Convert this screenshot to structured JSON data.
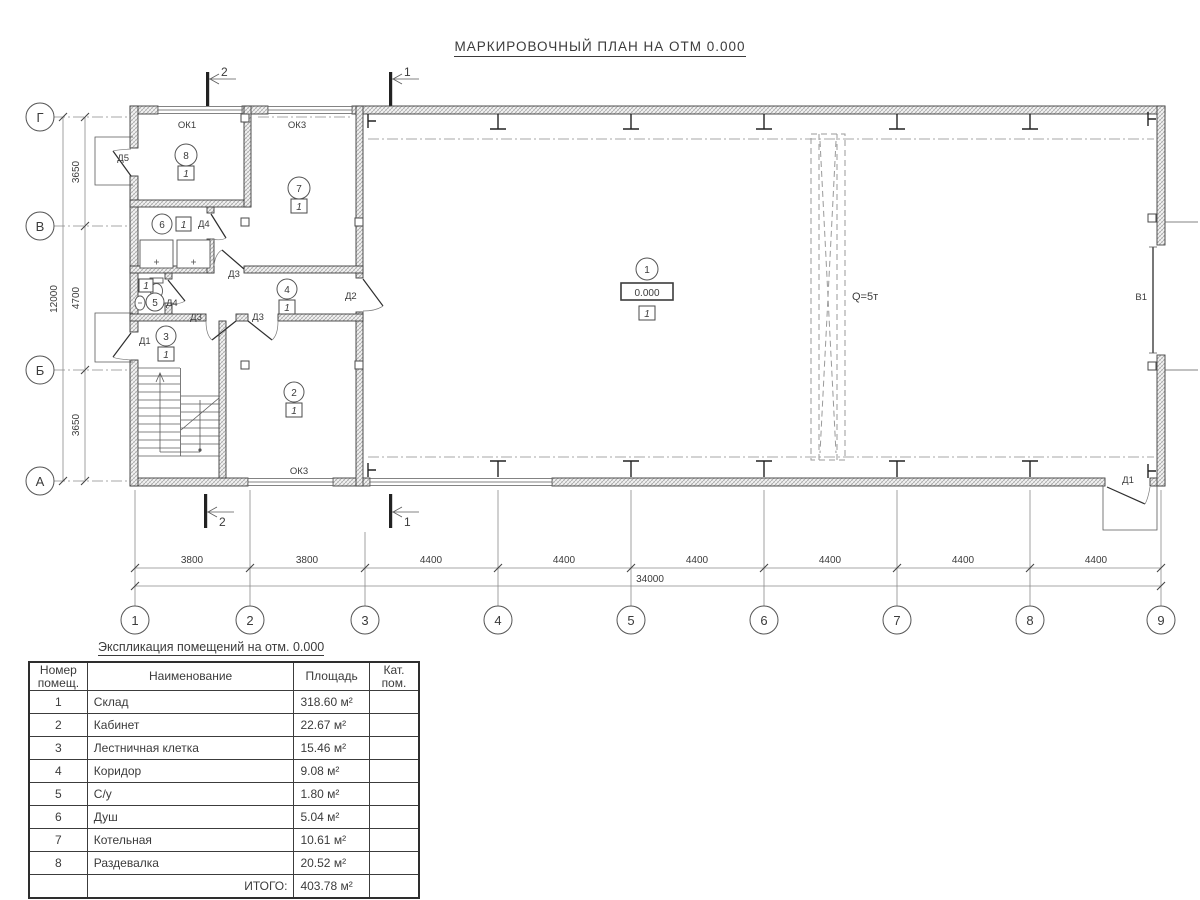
{
  "title": "МАРКИРОВОЧНЫЙ ПЛАН НА ОТМ 0.000",
  "plan": {
    "row_axes": [
      "Г",
      "В",
      "Б",
      "А"
    ],
    "col_axes": [
      "1",
      "2",
      "3",
      "4",
      "5",
      "6",
      "7",
      "8",
      "9"
    ],
    "dims_left": [
      "3650",
      "4700",
      "3650"
    ],
    "dim_left_total": "12000",
    "dims_bottom": [
      "3800",
      "3800",
      "4400",
      "4400",
      "4400",
      "4400",
      "4400",
      "4400"
    ],
    "dim_bottom_total": "34000",
    "section_marks": {
      "top": [
        "2",
        "1"
      ],
      "bottom": [
        "2",
        "1"
      ]
    },
    "crane_label": "Q=5т",
    "gate_label": "В1",
    "labels": {
      "d1_left": "Д1",
      "d1_right": "Д1",
      "d2": "Д2",
      "d3_a": "Д3",
      "d3_b": "Д3",
      "d3_c": "Д3",
      "d4_a": "Д4",
      "d4_b": "Д4",
      "d5": "Д5",
      "ok1": "ОК1",
      "ok3_top": "ОК3",
      "ok3_bottom": "ОК3"
    },
    "rooms": {
      "r1": {
        "num": "1",
        "cat": "1",
        "elev": "0.000"
      },
      "r2": {
        "num": "2",
        "cat": "1"
      },
      "r3": {
        "num": "3",
        "cat": "1"
      },
      "r4": {
        "num": "4",
        "cat": "1"
      },
      "r5": {
        "num": "5",
        "cat": "1"
      },
      "r6": {
        "num": "6",
        "cat": "1"
      },
      "r7": {
        "num": "7",
        "cat": "1"
      },
      "r8": {
        "num": "8",
        "cat": "1"
      }
    }
  },
  "table": {
    "title": "Экспликация помещений на отм. 0.000",
    "headers": {
      "num": "Номер помещ.",
      "name": "Наименование",
      "area": "Площадь",
      "cat": "Кат. пом."
    },
    "rows": [
      {
        "num": "1",
        "name": "Склад",
        "area": "318.60 м²"
      },
      {
        "num": "2",
        "name": "Кабинет",
        "area": "22.67 м²"
      },
      {
        "num": "3",
        "name": "Лестничная клетка",
        "area": "15.46 м²"
      },
      {
        "num": "4",
        "name": "Коридор",
        "area": "9.08 м²"
      },
      {
        "num": "5",
        "name": "С/у",
        "area": "1.80 м²"
      },
      {
        "num": "6",
        "name": "Душ",
        "area": "5.04 м²"
      },
      {
        "num": "7",
        "name": "Котельная",
        "area": "10.61 м²"
      },
      {
        "num": "8",
        "name": "Раздевалка",
        "area": "20.52 м²"
      }
    ],
    "total_label": "ИТОГО:",
    "total_area": "403.78 м²"
  }
}
